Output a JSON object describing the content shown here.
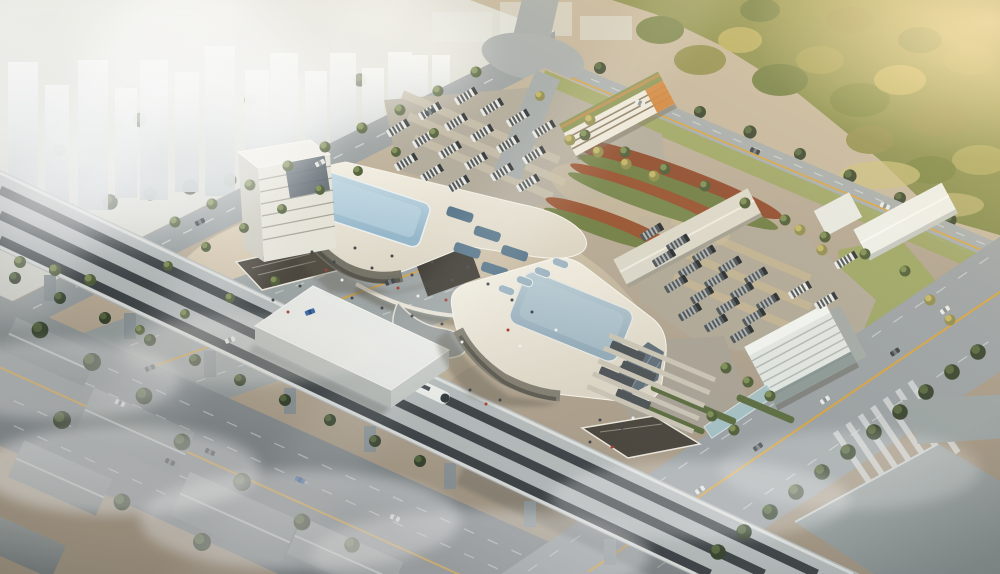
{
  "scene": {
    "type": "aerial-architectural-rendering",
    "subject": "intermodal-transit-hub-complex",
    "view": "bird's-eye oblique, hazy warm sunlight from upper right, mist over lower left",
    "regions": {
      "city_skyline": {
        "name": "high-rise residential towers in haze",
        "tower_count": 15
      },
      "forest": {
        "name": "sunlit woodland",
        "position": "top-right"
      },
      "terminal_main": {
        "name": "main station hall with rooftop glass skylight and office tower",
        "skylights": 6
      },
      "terminal_south": {
        "name": "secondary station hall with rooftop glass skylight",
        "skylights": 5
      },
      "rail_viaduct": {
        "name": "elevated multi-track railway crossing site diagonally",
        "tracks": 3,
        "train_count": 1
      },
      "track_station_box": {
        "name": "white station box straddling the viaduct"
      },
      "bus_parking_west": {
        "name": "bus parking lot",
        "bus_count": 18
      },
      "bus_parking_east": {
        "name": "bus parking lot",
        "bus_count": 22
      },
      "bus_bays": {
        "name": "bus boarding bays",
        "bus_count": 4
      },
      "parking_structure": {
        "name": "linear parking garage with planted roof and orange accents"
      },
      "office_building": {
        "name": "banded office block near east road"
      },
      "canopies": {
        "name": "long platform canopies",
        "count": 3
      },
      "landscape_mounds": {
        "name": "terraced planting mounds with red and green stripes"
      },
      "roads": {
        "name": "arterial roads with yellow centerlines, lane dashes, crosswalk and cars",
        "car_count": 20
      },
      "plaza": {
        "name": "pedestrian plaza with scattered people",
        "people_count": 37
      },
      "industrial_southwest": {
        "name": "warehouses in fog",
        "building_count": 6
      },
      "warehouse_southeast": {
        "name": "large flat-roof warehouses"
      }
    }
  },
  "palette": {
    "base_ground": "#c3b59d",
    "ground_top": "#cdbfa8",
    "ground_bottom": "#a29582",
    "plaza_light": "#e3d5bc",
    "plaza_shade": "#b9ab93",
    "city_ground": "#dfe0da",
    "tower_top": "#f4f5f3",
    "tower_bottom": "#c2c9cc",
    "forest_base_light": "#9c9a52",
    "forest_base_dark": "#6f7c41",
    "forest_gold": "#c2b464",
    "lawn": "#9aa55e",
    "road_asphalt": "#9ba1a2",
    "road_dark": "#7f8689",
    "road_light": "#abb1b1",
    "yellow_line": "#d9a33c",
    "lane_dash": "#dadedd",
    "viaduct_deck": "#b7bcbc",
    "viaduct_parapet": "#dfe2df",
    "track_dark": "#3b4144",
    "pier": "#8d9699",
    "roof_bright": "#f7f3e7",
    "roof_cream": "#ece7d9",
    "roof_shade": "#ddd6c5",
    "skylight_light": "#c7dde8",
    "skylight_blue": "#93b7cc",
    "skylight_t2_light": "#bccfd8",
    "skylight_t2_blue": "#93abb9",
    "glass_dark": "#5f6d78",
    "glass_band": "#6e6c5f",
    "station_box_top": "#ebece8",
    "b4_white": "#eee9dc",
    "b4_orange": "#cf7f35",
    "b4_green_roof": "#85914e",
    "b3_white": "#e2e6e2",
    "b3_band": "#b2b8b4",
    "canopy": "#dcd8c9",
    "canopy_white": "#edeee9",
    "glass_canopy": "#a4c6cc",
    "bus_white": "#e9eae7",
    "bus_dark": "#4b5154",
    "bus_stripe_dark": "#34393b",
    "bus_stripe_light": "#c6cbcb",
    "car_white": "#e8eae8",
    "car_dark": "#3c4246",
    "car_blue": "#3465a8",
    "pit_dark": "#48433a",
    "planting_red": "#8f4a2c",
    "planting_green": "#6f7d42",
    "warehouse_roof": "#aeb6b6",
    "warehouse_side": "#8d9798",
    "warehouse_se": "#9aa2a2",
    "people_dark": "#3f4347",
    "people_red": "#a63a2e",
    "people_white": "#f2f2ee",
    "fog_white": "#ffffff",
    "sun_warm": "#ffe9b4",
    "shadow_warm": "#5e584a"
  }
}
